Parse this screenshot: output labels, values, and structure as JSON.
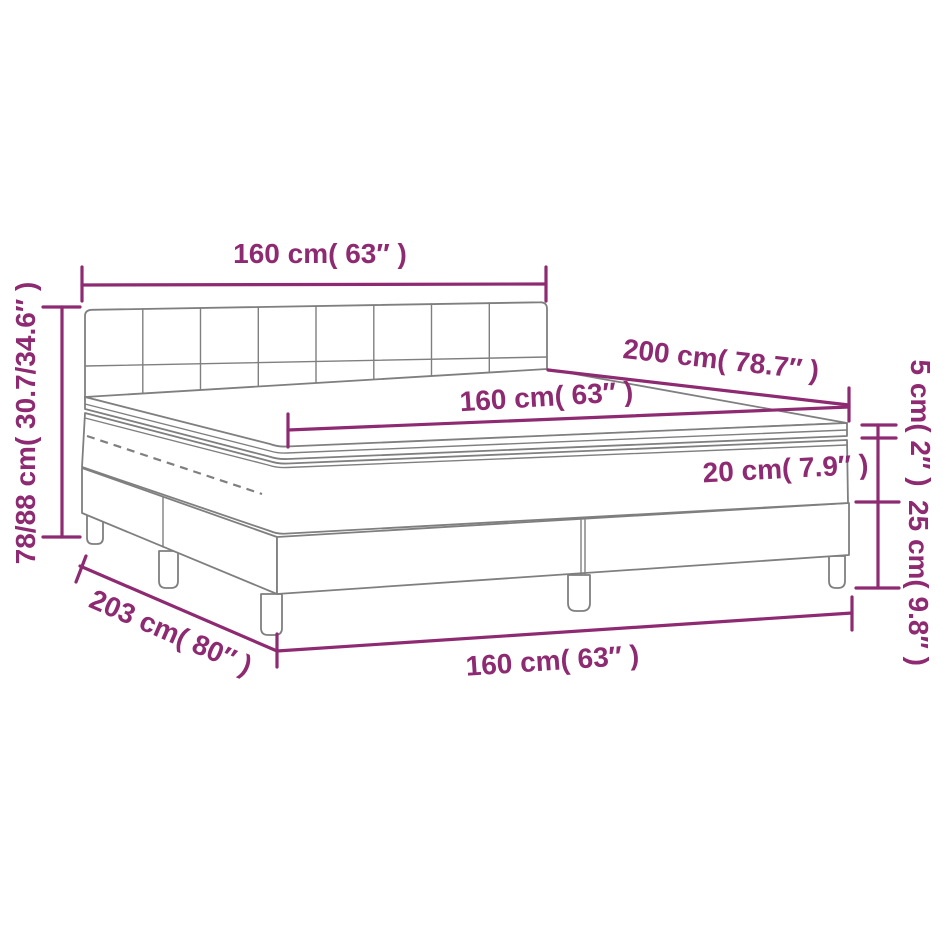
{
  "diagram": {
    "illustration": "box-spring-bed-with-headboard-mattress-and-topper",
    "labels": {
      "headboard_width": "160 cm( 63″ )",
      "bed_length": "200 cm( 78.7″ )",
      "mattress_width": "160 cm( 63″ )",
      "topper_height": "5 cm( 2″ )",
      "mattress_height": "20 cm( 7.9″ )",
      "base_height": "25 cm( 9.8″ )",
      "frame_length": "203 cm( 80″ )",
      "frame_width": "160 cm( 63″ )",
      "overall_height": "78/88 cm( 30.7/34.6″ )"
    },
    "colors": {
      "dimension": "#8e2a71",
      "drawing": "#7f7f7f",
      "background": "#ffffff"
    }
  }
}
